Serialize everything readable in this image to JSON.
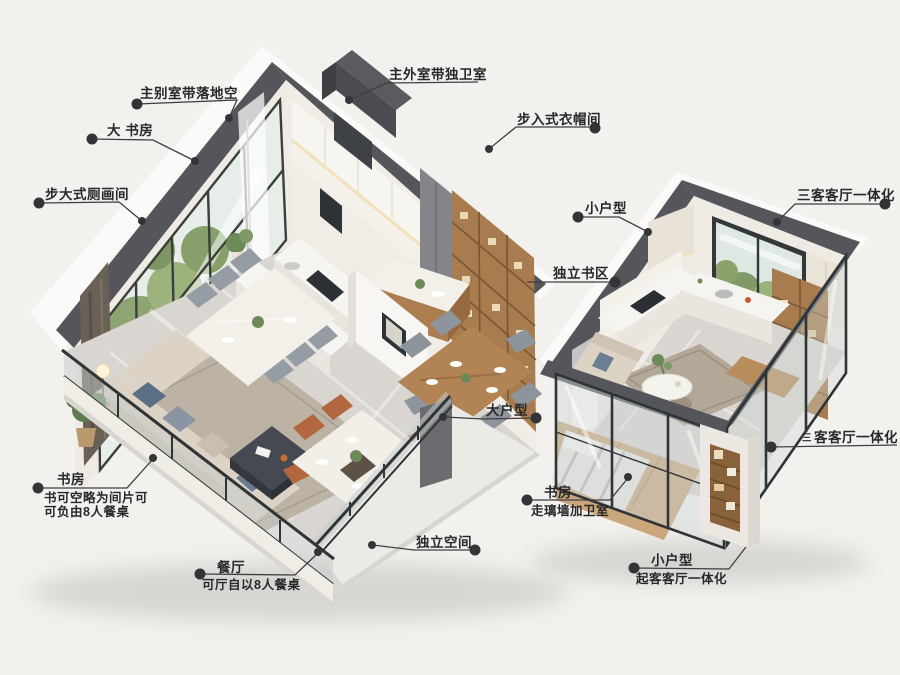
{
  "scene": {
    "type": "isometric-floorplan-comparison",
    "units": [
      {
        "id": "large-unit",
        "rooms": [
          "kitchen",
          "dining",
          "living",
          "walk-in-closet",
          "balcony"
        ]
      },
      {
        "id": "small-unit",
        "rooms": [
          "kitchen",
          "living",
          "bedroom",
          "bookshelf-column"
        ]
      }
    ]
  },
  "callouts": [
    {
      "id": "master-bedroom-window",
      "text": "主别室带落地空"
    },
    {
      "id": "big-study",
      "text": "大 书房"
    },
    {
      "id": "walkin-closet-left",
      "text": "步大式厕画间"
    },
    {
      "id": "master-bath",
      "text": "主外室带独卫室"
    },
    {
      "id": "walkin-closet",
      "text": "步入式衣帽间"
    },
    {
      "id": "small-unit",
      "text": "小户型"
    },
    {
      "id": "living-dining-integrated-top",
      "text": "三客客厅一体化"
    },
    {
      "id": "independent-study-area",
      "text": "独立书区"
    },
    {
      "id": "large-unit",
      "text": "大户型"
    },
    {
      "id": "study-bottom-left",
      "text": "书房",
      "sub1": "书可空略为间片可",
      "sub2": "可负由8人餐桌"
    },
    {
      "id": "dining-room",
      "text": "餐厅",
      "sub1": "可厅自以8人餐桌"
    },
    {
      "id": "independent-space",
      "text": "独立空间"
    },
    {
      "id": "study-right",
      "text": "书房",
      "sub1": "走璃墙加卫室"
    },
    {
      "id": "small-unit-bottom",
      "text": "小户型",
      "sub1": "起客客厅一体化"
    },
    {
      "id": "living-dining-integrated-right",
      "text": "客客厅一体化",
      "prefix": "三"
    }
  ],
  "colors": {
    "background": "#f2f1ee",
    "wall_top_band": "#55565b",
    "wall_face": "#efebe4",
    "outer_wall": "#fbfaf8",
    "marble_floor": "#d9d5d0",
    "wood_cabinet": "#a87c4e",
    "sofa_beige": "#dcd3c4",
    "rug": "#bcb3a5",
    "accent_chair": "#b2673f",
    "glass": "#c3cfcc",
    "label_text": "#28282a",
    "leader_line": "#3f3f42"
  }
}
